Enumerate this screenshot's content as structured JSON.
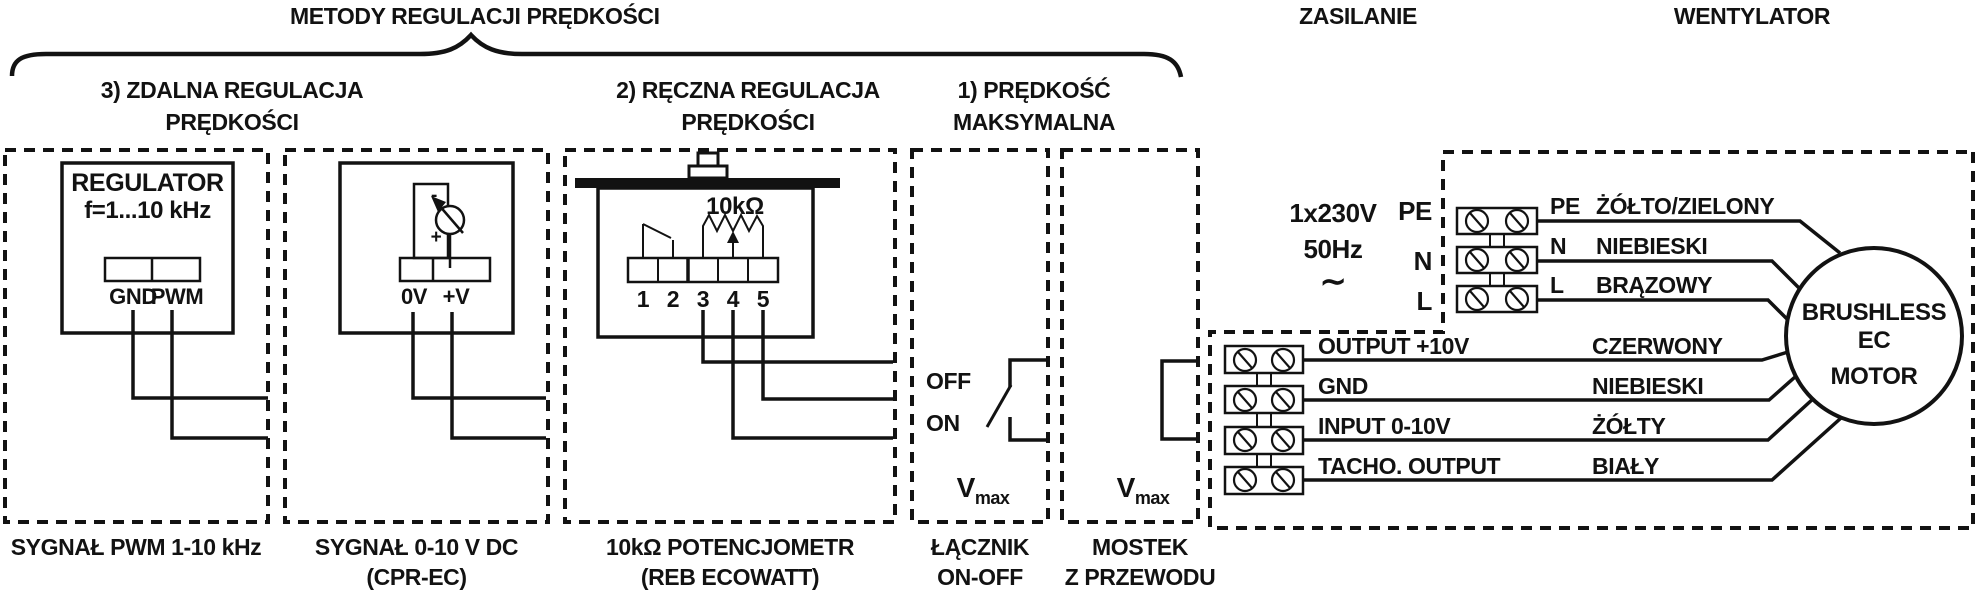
{
  "title": "METODY REGULACJI PRĘDKOŚCI",
  "sections": {
    "zasilanie": "ZASILANIE",
    "wentylator": "WENTYLATOR"
  },
  "headings": {
    "remote": [
      "3) ZDALNA REGULACJA",
      "PRĘDKOŚCI"
    ],
    "manual": [
      "2) RĘCZNA REGULACJA",
      "PRĘDKOŚCI"
    ],
    "maxspeed": [
      "1) PRĘDKOŚĆ",
      "MAKSYMALNA"
    ]
  },
  "pwm_box": {
    "device": "REGULATOR",
    "freq": "f=1...10 kHz",
    "terminals": [
      "GND",
      "PWM"
    ],
    "caption": "SYGNAŁ PWM 1-10 kHz"
  },
  "dc_box": {
    "minus": "-",
    "plus": "+",
    "terminals": [
      "0V",
      "+V"
    ],
    "caption": [
      "SYGNAŁ 0-10 V DC",
      "(CPR-EC)"
    ]
  },
  "pot_box": {
    "value": "10kΩ",
    "terminals": [
      "1",
      "2",
      "3",
      "4",
      "5"
    ],
    "caption": [
      "10kΩ POTENCJOMETR",
      "(REB ECOWATT)"
    ]
  },
  "switch_box": {
    "off": "OFF",
    "on": "ON",
    "vmax_v": "V",
    "vmax_sub": "max",
    "caption": [
      "ŁĄCZNIK",
      "ON-OFF"
    ]
  },
  "jumper_box": {
    "vmax_v": "V",
    "vmax_sub": "max",
    "caption": [
      "MOSTEK",
      "Z PRZEWODU"
    ]
  },
  "power": {
    "voltage": "1x230V",
    "frequency": "50Hz",
    "ac": "∼",
    "terminals": [
      "PE",
      "N",
      "L"
    ],
    "wires": [
      {
        "terminal": "PE",
        "color": "ŻÓŁTO/ZIELONY"
      },
      {
        "terminal": "N",
        "color": "NIEBIESKI"
      },
      {
        "terminal": "L",
        "color": "BRĄZOWY"
      }
    ]
  },
  "signals": {
    "wires": [
      {
        "label": "OUTPUT +10V",
        "color": "CZERWONY"
      },
      {
        "label": "GND",
        "color": "NIEBIESKI"
      },
      {
        "label": "INPUT 0-10V",
        "color": "ŻÓŁTY"
      },
      {
        "label": "TACHO. OUTPUT",
        "color": "BIAŁY"
      }
    ]
  },
  "motor": {
    "lines": [
      "BRUSHLESS",
      "EC",
      "MOTOR"
    ]
  },
  "colors": {
    "ink": "#121212",
    "background": "#ffffff"
  }
}
